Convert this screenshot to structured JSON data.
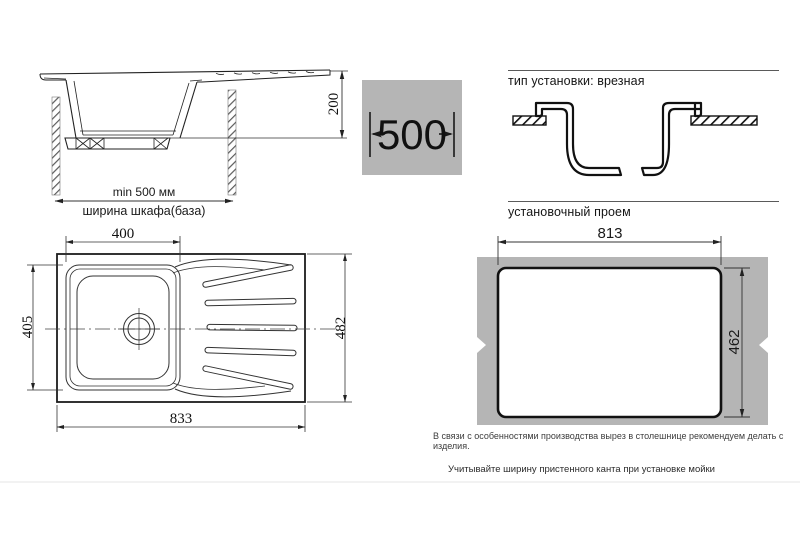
{
  "colors": {
    "gray_fill": "#b5b5b5",
    "line": "#222222",
    "thin_line": "#333333",
    "rule": "#f2f2f2"
  },
  "side_view": {
    "height_dim": "200",
    "min_width_label": "min 500 мм",
    "cabinet_label": "ширина шкафа(база)"
  },
  "cabinet_width_badge": {
    "value": "500"
  },
  "install_type_section": {
    "title": "тип установки: врезная"
  },
  "cutout_section": {
    "title": "установочный проем",
    "width_dim": "813",
    "height_dim": "462",
    "production_note": "В связи с особенностями производства вырез в столешнице рекомендуем делать с изделия."
  },
  "top_view": {
    "bowl_width_dim": "400",
    "bowl_depth_dim": "405",
    "overall_width_dim": "833",
    "overall_depth_dim": "482"
  },
  "footer_note": "Учитывайте ширину пристенного канта при установке мойки"
}
